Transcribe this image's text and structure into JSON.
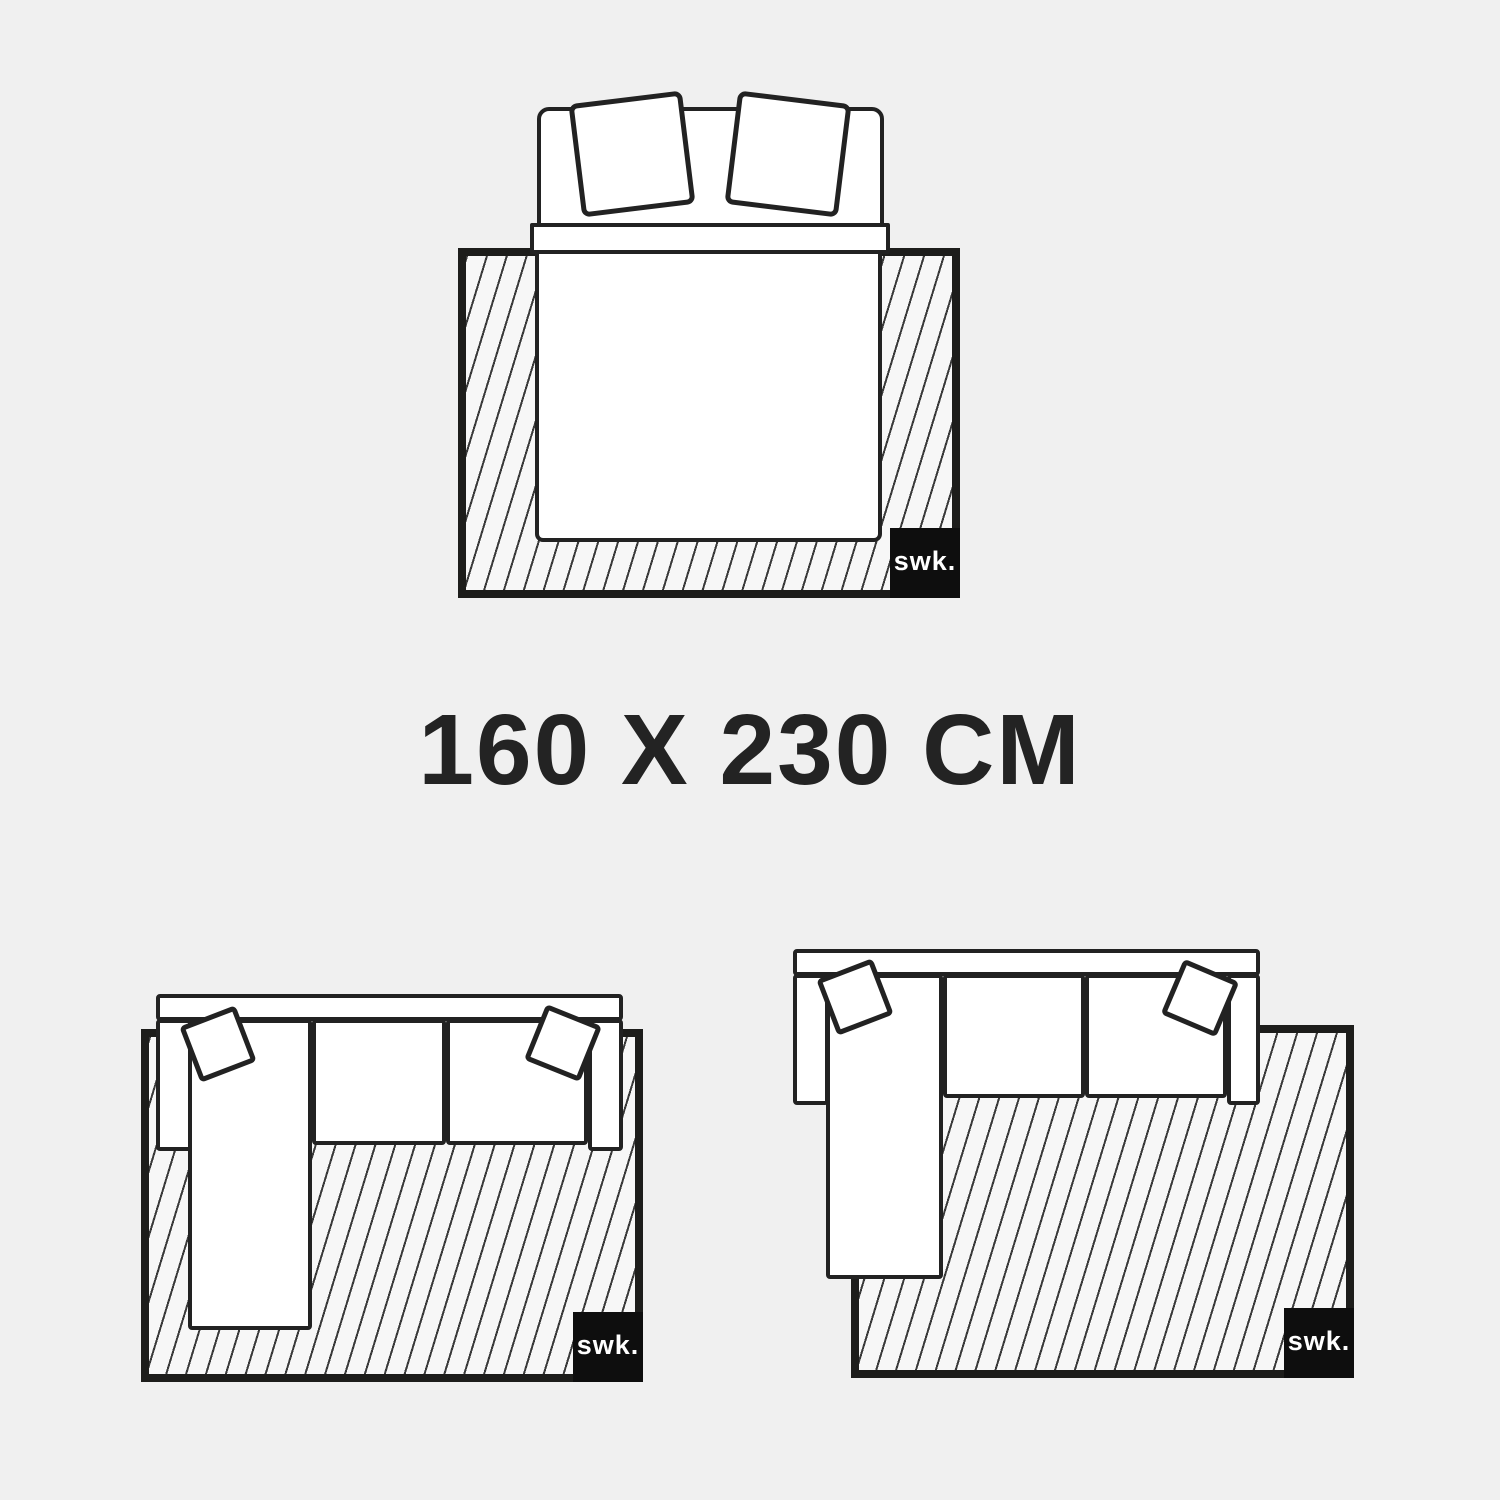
{
  "title": {
    "text": "160 X 230 CM",
    "color": "#232323"
  },
  "brand": {
    "text": "swk.",
    "bg": "#0e0e0e",
    "fg": "#ffffff"
  },
  "scenes": [
    {
      "name": "double-bed-on-rug",
      "logo": "swk."
    },
    {
      "name": "corner-sofa-chaise-left-on-rug",
      "logo": "swk."
    },
    {
      "name": "corner-sofa-offset-right-on-rug",
      "logo": "swk."
    }
  ],
  "colors": {
    "background": "#f0f0f0",
    "outline": "#222222",
    "rug_border": "#1d1d1b",
    "rug_fill": "#f7f7f7",
    "hatch_line": "#3a3a3a",
    "furniture_fill": "#ffffff"
  }
}
